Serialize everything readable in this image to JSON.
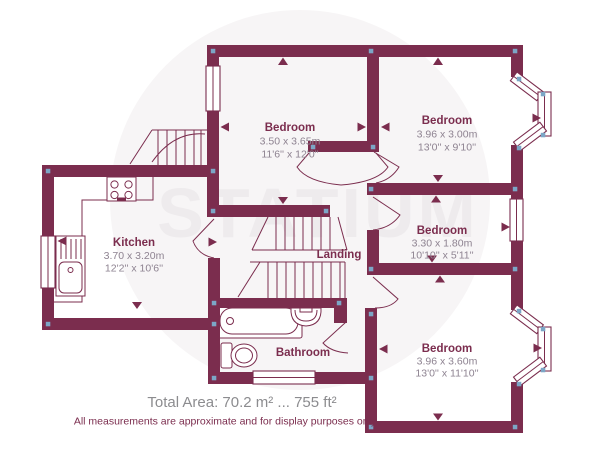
{
  "watermark": "STATIUM",
  "colors": {
    "wall": "#7b2d4e",
    "dimension_text": "#8e8391",
    "room_label_text": "#7b2d4e",
    "corner_marker": "#7ca6c6",
    "watermark_text": "#eeebed",
    "background_circle": "#f7f5f6",
    "footer_area_text": "#8c8c8f"
  },
  "rooms": [
    {
      "name": "Bedroom",
      "metric": "3.50 x 3.65m",
      "imperial": "11'6'' x 12'0''"
    },
    {
      "name": "Bedroom",
      "metric": "3.96 x 3.00m",
      "imperial": "13'0'' x 9'10''"
    },
    {
      "name": "Bedroom",
      "metric": "3.30 x 1.80m",
      "imperial": "10'10'' x 5'11''"
    },
    {
      "name": "Bedroom",
      "metric": "3.96 x 3.60m",
      "imperial": "13'0'' x 11'10''"
    },
    {
      "name": "Kitchen",
      "metric": "3.70 x 3.20m",
      "imperial": "12'2'' x 10'6''"
    },
    {
      "name": "Landing"
    },
    {
      "name": "Bathroom"
    }
  ],
  "footer": {
    "total_area": "Total Area: 70.2 m² ... 755 ft²",
    "disclaimer": "All measurements are approximate and for display purposes only"
  }
}
